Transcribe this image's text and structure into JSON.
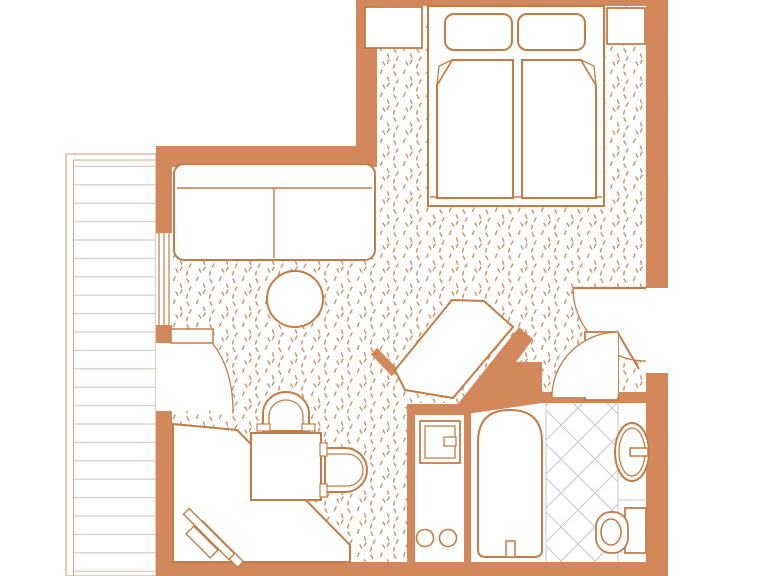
{
  "canvas": {
    "width": 767,
    "height": 576
  },
  "palette": {
    "wall": "#d2885a",
    "line": "#c47c46",
    "white": "#ffffff",
    "stipple": "#c79770",
    "plank": "#d3ccc7",
    "softline": "#d9a87e",
    "tileline": "#c6c6ce"
  },
  "patterns": {
    "stipple": {
      "size": 23,
      "stroke_width": 1.5,
      "marks": [
        [
          3,
          3,
          4.8,
          6.2
        ],
        [
          14,
          1,
          12.6,
          4.3
        ],
        [
          19.5,
          8,
          20.7,
          11.3
        ],
        [
          7,
          11,
          5.2,
          14.1
        ],
        [
          15,
          16,
          16.8,
          19.1
        ],
        [
          3.5,
          18.5,
          2.6,
          21.9
        ],
        [
          21,
          14,
          19.4,
          17.2
        ]
      ]
    },
    "planks": {
      "width": 12,
      "height": 18.4,
      "stroke_width": 1.2
    },
    "tile": {
      "size": 34,
      "stroke_width": 1
    }
  },
  "elements": [
    {
      "t": "polygon",
      "n": "room-floor-carpet",
      "pts": "377,6 646,6 646,392 540,392 540,368 507,368 528,333 459,407 408,407 408,562 172,562 172,167 377,167",
      "f": "p:stipple"
    },
    {
      "t": "rect",
      "n": "balcony",
      "x": 66,
      "y": 154,
      "w": 90,
      "h": 422,
      "f": "white",
      "s": "softline",
      "sw": 1.2
    },
    {
      "t": "rect",
      "n": "balcony-decking",
      "x": 73.5,
      "y": 160,
      "w": 82.5,
      "h": 416,
      "f": "p:planks",
      "s": "softline",
      "sw": 1
    },
    {
      "t": "rect",
      "n": "bathroom-floor",
      "x": 409,
      "y": 403,
      "w": 237,
      "h": 164,
      "f": "white"
    },
    {
      "t": "rect",
      "n": "bathroom-tile-floor",
      "x": 546,
      "y": 403,
      "w": 72,
      "h": 164,
      "f": "p:tile"
    },
    {
      "t": "line",
      "n": "tile-edge-left",
      "x1": 546,
      "y1": 403,
      "x2": 546,
      "y2": 567,
      "s": "tileline",
      "sw": 1
    },
    {
      "t": "line",
      "n": "vanity-edge",
      "x1": 618,
      "y1": 403,
      "x2": 618,
      "y2": 567,
      "s": "tileline",
      "sw": 1
    },
    {
      "t": "line",
      "n": "vanity-counter-step",
      "x1": 618,
      "y1": 500,
      "x2": 646,
      "y2": 500,
      "s": "tileline",
      "sw": 1
    },
    {
      "t": "rect",
      "n": "wall-top",
      "x": 356,
      "y": 0,
      "w": 312,
      "h": 6,
      "f": "wall"
    },
    {
      "t": "rect",
      "n": "wall-bedroom-left",
      "x": 356,
      "y": 0,
      "w": 21,
      "h": 147,
      "f": "wall"
    },
    {
      "t": "rect",
      "n": "wall-living-top",
      "x": 156,
      "y": 146,
      "w": 221,
      "h": 21,
      "f": "wall"
    },
    {
      "t": "rect",
      "n": "wall-left-upper",
      "x": 156,
      "y": 167,
      "w": 16,
      "h": 66,
      "f": "wall"
    },
    {
      "t": "rect",
      "n": "wall-left-mid",
      "x": 156,
      "y": 325,
      "w": 16,
      "h": 18,
      "f": "wall"
    },
    {
      "t": "rect",
      "n": "wall-left-lower",
      "x": 156,
      "y": 411,
      "w": 16,
      "h": 165,
      "f": "wall"
    },
    {
      "t": "rect",
      "n": "wall-bottom",
      "x": 156,
      "y": 562,
      "w": 512,
      "h": 14,
      "f": "wall"
    },
    {
      "t": "rect",
      "n": "wall-right-upper",
      "x": 646,
      "y": 0,
      "w": 22,
      "h": 288,
      "f": "wall"
    },
    {
      "t": "rect",
      "n": "wall-right-lower",
      "x": 646,
      "y": 373,
      "w": 22,
      "h": 203,
      "f": "wall"
    },
    {
      "t": "rect",
      "n": "wall-bathroom-top",
      "x": 536,
      "y": 392,
      "w": 132,
      "h": 11,
      "f": "wall"
    },
    {
      "t": "rect",
      "n": "wall-kitchenette-top",
      "x": 407,
      "y": 404,
      "w": 60,
      "h": 11,
      "f": "wall"
    },
    {
      "t": "rect",
      "n": "wall-kitchenette-left",
      "x": 407,
      "y": 404,
      "w": 8,
      "h": 158,
      "f": "wall"
    },
    {
      "t": "rect",
      "n": "wall-kitchenette-divider",
      "x": 464,
      "y": 404,
      "w": 7,
      "h": 163,
      "f": "wall"
    },
    {
      "t": "polygon",
      "n": "wall-diagonal",
      "pts": "449,415 519,327 533,339 516,362 542,362 542,403 460,415",
      "f": "wall"
    },
    {
      "t": "line",
      "n": "wall-stub-diagonal",
      "x1": 374,
      "y1": 351,
      "x2": 395,
      "y2": 373,
      "s": "wall",
      "sw": 9
    },
    {
      "t": "rect",
      "n": "window-glass",
      "x": 156,
      "y": 233,
      "w": 16,
      "h": 92,
      "f": "white"
    },
    {
      "t": "line",
      "n": "window-pane-outer",
      "x1": 159,
      "y1": 233,
      "x2": 159,
      "y2": 325,
      "s": "line",
      "sw": 1.2
    },
    {
      "t": "line",
      "n": "window-pane-mid",
      "x1": 164,
      "y1": 233,
      "x2": 164,
      "y2": 325,
      "s": "line",
      "sw": 1.2
    },
    {
      "t": "line",
      "n": "window-pane-inner",
      "x1": 169,
      "y1": 233,
      "x2": 169,
      "y2": 325,
      "s": "line",
      "sw": 1.2
    },
    {
      "t": "rect",
      "n": "balcony-doorway",
      "x": 156,
      "y": 343,
      "w": 16,
      "h": 68,
      "f": "white"
    },
    {
      "t": "path",
      "n": "balcony-door-swing",
      "d": "M172,343 L212,343 C227,361 233,386 233,411 L172,411 Z",
      "f": "white"
    },
    {
      "t": "path",
      "n": "balcony-door-arc",
      "d": "M212,343 C227,361 233,386 233,411",
      "s": "line",
      "sw": 1.3
    },
    {
      "t": "rect",
      "n": "balcony-door-leaf",
      "x": 171,
      "y": 329,
      "w": 42,
      "h": 14,
      "f": "white",
      "s": "line",
      "sw": 1.5
    },
    {
      "t": "rect",
      "n": "sofa",
      "x": 174,
      "y": 164,
      "w": 201,
      "h": 96,
      "rx": 10,
      "f": "white",
      "s": "line",
      "sw": 2
    },
    {
      "t": "line",
      "n": "sofa-backrest-line",
      "x1": 177,
      "y1": 188,
      "x2": 372,
      "y2": 188,
      "s": "line",
      "sw": 1.4
    },
    {
      "t": "line",
      "n": "sofa-cushion-divider",
      "x1": 274,
      "y1": 188,
      "x2": 274,
      "y2": 258,
      "s": "line",
      "sw": 1.4
    },
    {
      "t": "circle",
      "n": "coffee-table",
      "cx": 295,
      "cy": 299,
      "r": 28,
      "f": "white",
      "s": "line",
      "sw": 2
    },
    {
      "t": "polygon",
      "n": "corner-desk",
      "pts": "173,424 237,430 350,545 350,562 173,562",
      "f": "white",
      "s": "line",
      "sw": 2
    },
    {
      "t": "rect",
      "n": "luggage-rack-bar-rear",
      "x": 191,
      "y": 540,
      "w": 58,
      "h": 8,
      "f": "white",
      "s": "line",
      "sw": 1.4,
      "tf": "rotate(45 220 544)"
    },
    {
      "t": "rect",
      "n": "luggage-rack-bar-front",
      "x": 177,
      "y": 530,
      "w": 64,
      "h": 8,
      "f": "white",
      "s": "line",
      "sw": 1.4,
      "tf": "rotate(45 209 534)"
    },
    {
      "t": "rect",
      "n": "luggage-rack-crossbar",
      "x": 185,
      "y": 536.5,
      "w": 34,
      "h": 11,
      "f": "white",
      "s": "line",
      "sw": 1.4,
      "tf": "rotate(45 202 542)"
    },
    {
      "t": "rect",
      "n": "dining-table",
      "x": 251,
      "y": 433,
      "w": 70,
      "h": 67,
      "f": "white",
      "s": "line",
      "sw": 2
    },
    {
      "t": "path",
      "n": "chair-top-outer",
      "d": "M263,431 L263,414 A23,22 0 0 1 309,414 L309,431 Z",
      "f": "white",
      "s": "line",
      "sw": 2
    },
    {
      "t": "path",
      "n": "chair-top-inner",
      "d": "M269,431 L269,416 A17,16 0 0 1 303,416 L303,431",
      "s": "line",
      "sw": 1.3
    },
    {
      "t": "rect",
      "n": "chair-top-cap-left",
      "x": 257,
      "y": 424,
      "w": 13,
      "h": 7,
      "f": "white",
      "s": "line",
      "sw": 1.2
    },
    {
      "t": "rect",
      "n": "chair-top-cap-right",
      "x": 302,
      "y": 424,
      "w": 13,
      "h": 7,
      "f": "white",
      "s": "line",
      "sw": 1.2
    },
    {
      "t": "path",
      "n": "chair-right-outer",
      "d": "M325,448 L345,448 A22,22 0 0 1 345,492 L325,492 Z",
      "f": "white",
      "s": "line",
      "sw": 2
    },
    {
      "t": "path",
      "n": "chair-right-inner",
      "d": "M325,454 L347,454 A16,16 0 0 1 347,486 L325,486",
      "s": "line",
      "sw": 1.3
    },
    {
      "t": "rect",
      "n": "chair-right-cap-top",
      "x": 320,
      "y": 443,
      "w": 7,
      "h": 13,
      "f": "white",
      "s": "line",
      "sw": 1.2
    },
    {
      "t": "rect",
      "n": "chair-right-cap-bottom",
      "x": 320,
      "y": 484,
      "w": 7,
      "h": 13,
      "f": "white",
      "s": "line",
      "sw": 1.2
    },
    {
      "t": "polygon",
      "n": "corner-cabinet",
      "pts": "395,370 452,300 484,301 513,327 453,398 405,390",
      "f": "white",
      "s": "line",
      "sw": 2
    },
    {
      "t": "rect",
      "n": "bed-frame",
      "x": 428,
      "y": 6,
      "w": 176,
      "h": 200,
      "f": "white",
      "s": "line",
      "sw": 2
    },
    {
      "t": "line",
      "n": "bed-footboard-line",
      "x1": 430,
      "y1": 197,
      "x2": 602,
      "y2": 197,
      "s": "line",
      "sw": 1.4
    },
    {
      "t": "rect",
      "n": "pillow-left",
      "x": 445,
      "y": 14,
      "w": 67,
      "h": 36,
      "rx": 9,
      "f": "white",
      "s": "line",
      "sw": 2
    },
    {
      "t": "rect",
      "n": "pillow-right",
      "x": 518,
      "y": 14,
      "w": 67,
      "h": 36,
      "rx": 9,
      "f": "white",
      "s": "line",
      "sw": 2
    },
    {
      "t": "polygon",
      "n": "mattress-left",
      "pts": "452,60 513,60 513,198 437,198 437,85",
      "f": "white",
      "s": "line",
      "sw": 2
    },
    {
      "t": "path",
      "n": "mattress-left-fold",
      "d": "M437,85 L452,60 L439,66 Z",
      "f": "white",
      "s": "line",
      "sw": 1.3
    },
    {
      "t": "polygon",
      "n": "mattress-right",
      "pts": "522,60 581,60 596,85 596,198 522,198",
      "f": "white",
      "s": "line",
      "sw": 2
    },
    {
      "t": "path",
      "n": "mattress-right-fold",
      "d": "M596,85 L581,60 L594,66 Z",
      "f": "white",
      "s": "line",
      "sw": 1.3
    },
    {
      "t": "rect",
      "n": "nightstand-left",
      "x": 365,
      "y": 7,
      "w": 57,
      "h": 41,
      "f": "white",
      "s": "line",
      "sw": 1.8
    },
    {
      "t": "rect",
      "n": "nightstand-right",
      "x": 607,
      "y": 8,
      "w": 38,
      "h": 36,
      "f": "white",
      "s": "line",
      "sw": 1.8
    },
    {
      "t": "path",
      "n": "entry-door-swing",
      "d": "M573,288 C573,328 606,361 646,361 L646,288 Z",
      "f": "white"
    },
    {
      "t": "path",
      "n": "entry-door-arc",
      "d": "M573,288 C573,328 606,361 646,361",
      "s": "line",
      "sw": 1.3
    },
    {
      "t": "line",
      "n": "entry-door-leaf",
      "x1": 573,
      "y1": 288,
      "x2": 646,
      "y2": 288,
      "s": "line",
      "sw": 2.2
    },
    {
      "t": "rect",
      "n": "entry-closet",
      "x": 585,
      "y": 332,
      "w": 33,
      "h": 68,
      "f": "white",
      "s": "line",
      "sw": 1.8
    },
    {
      "t": "path",
      "n": "bathroom-door-swing",
      "d": "M552,397 C552,361 582,332 618,332 L618,397 Z",
      "f": "white"
    },
    {
      "t": "path",
      "n": "bathroom-door-arc",
      "d": "M552,397 C552,361 582,332 618,332",
      "s": "line",
      "sw": 1.3
    },
    {
      "t": "line",
      "n": "bathroom-door-leaf",
      "x1": 618,
      "y1": 333,
      "x2": 639,
      "y2": 369,
      "s": "line",
      "sw": 2
    },
    {
      "t": "rect",
      "n": "kitchenette-cabinet",
      "x": 420,
      "y": 421,
      "w": 40,
      "h": 42,
      "f": "white",
      "s": "line",
      "sw": 1.8
    },
    {
      "t": "rect",
      "n": "kitchenette-cabinet-inner",
      "x": 425,
      "y": 426,
      "w": 30,
      "h": 32,
      "s": "line",
      "sw": 1.3
    },
    {
      "t": "rect",
      "n": "kitchenette-cabinet-handle",
      "x": 444,
      "y": 437,
      "w": 12,
      "h": 9,
      "f": "white",
      "s": "line",
      "sw": 1.3
    },
    {
      "t": "circle",
      "n": "burner-left",
      "cx": 425,
      "cy": 538,
      "r": 8.5,
      "f": "white",
      "s": "line",
      "sw": 1.6
    },
    {
      "t": "circle",
      "n": "burner-right",
      "cx": 448,
      "cy": 538,
      "r": 8.5,
      "f": "white",
      "s": "line",
      "sw": 1.6
    },
    {
      "t": "path",
      "n": "bathtub",
      "d": "M478,550 L478,442 Q478,410 510,410 Q542,410 542,442 L542,550 Q542,557 534,557 L486,557 Q478,557 478,550 Z",
      "f": "white",
      "s": "line",
      "sw": 2
    },
    {
      "t": "rect",
      "n": "bathtub-faucet",
      "x": 506,
      "y": 541,
      "w": 9,
      "h": 16,
      "f": "white",
      "s": "line",
      "sw": 1.5
    },
    {
      "t": "ellipse",
      "n": "sink-basin-outer",
      "cx": 632,
      "cy": 452,
      "rx": 17,
      "ry": 29,
      "f": "white",
      "s": "line",
      "sw": 2
    },
    {
      "t": "ellipse",
      "n": "sink-basin-inner",
      "cx": 632,
      "cy": 452,
      "rx": 13,
      "ry": 24,
      "s": "line",
      "sw": 1.3
    },
    {
      "t": "rect",
      "n": "sink-faucet",
      "x": 630,
      "y": 448,
      "w": 18,
      "h": 8,
      "f": "white",
      "s": "line",
      "sw": 1.5
    },
    {
      "t": "rect",
      "n": "toilet-tank",
      "x": 625,
      "y": 508,
      "w": 21,
      "h": 45,
      "f": "white",
      "s": "line",
      "sw": 1.8
    },
    {
      "t": "rect",
      "n": "toilet-bowl",
      "x": 596,
      "y": 512,
      "w": 32,
      "h": 41,
      "rx": 15,
      "f": "white",
      "s": "line",
      "sw": 1.8
    },
    {
      "t": "ellipse",
      "n": "toilet-seat",
      "cx": 611,
      "cy": 532,
      "rx": 10,
      "ry": 13,
      "s": "line",
      "sw": 1.6
    }
  ]
}
